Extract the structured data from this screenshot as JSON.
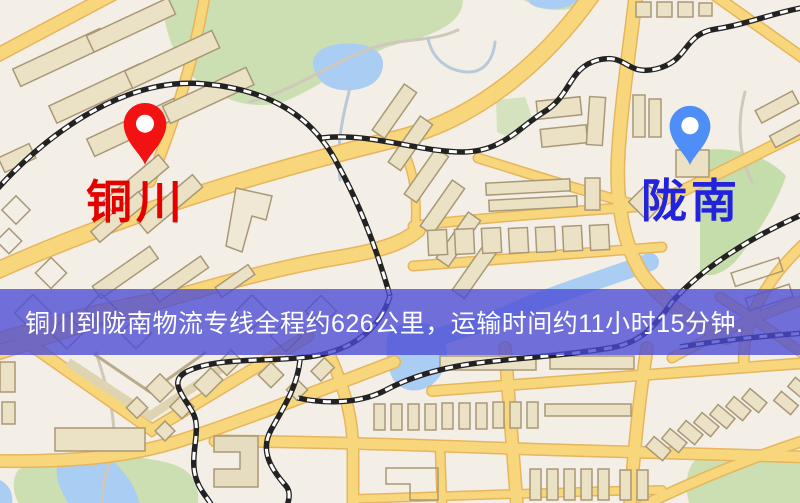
{
  "map": {
    "origin": {
      "label": "铜川",
      "pin_color": "#f31212",
      "label_color": "#e50000"
    },
    "destination": {
      "label": "陇南",
      "pin_color": "#4f8ef6",
      "label_color": "#2323db"
    }
  },
  "banner": {
    "text": "铜川到陇南物流专线全程约626公里，运输时间约11小时15分钟.",
    "background_color": "#4a4ad5",
    "text_color": "#ffffff"
  },
  "map_colors": {
    "background": "#f4efe6",
    "road_fill": "#f8d77c",
    "road_casing": "#e6b55e",
    "railway": "#222222",
    "railway_dash": "#ffffff",
    "water": "#a9cdf3",
    "park": "#cbdfb2",
    "building_fill": "#ebe2c5",
    "building_outline": "#a99877"
  }
}
